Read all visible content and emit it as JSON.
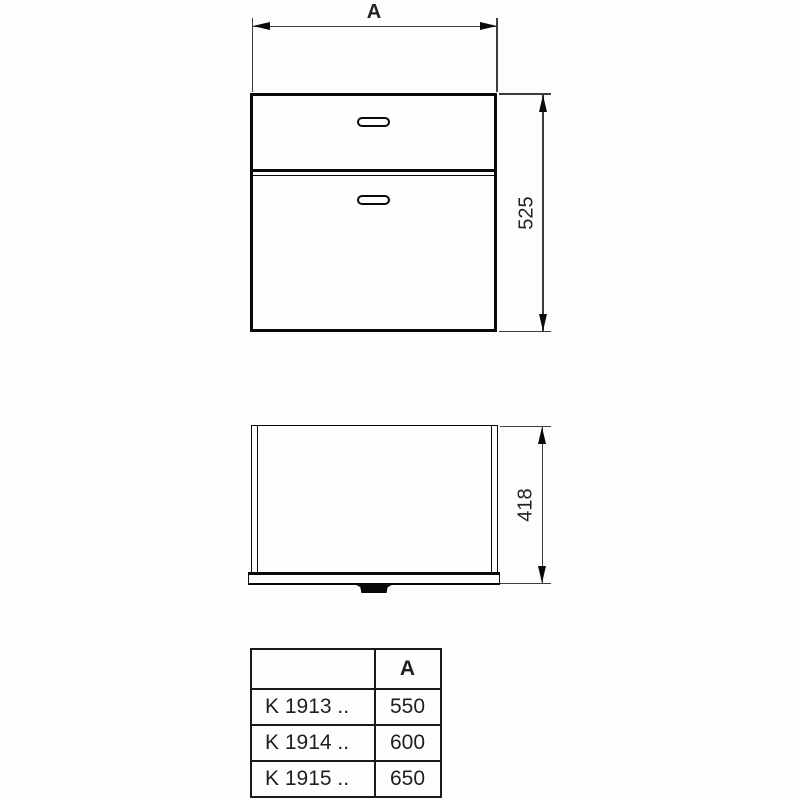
{
  "dims": {
    "width_label": "A",
    "height_value": "525",
    "depth_value": "418"
  },
  "table": {
    "headers": {
      "model": "",
      "a": "A"
    },
    "rows": [
      {
        "model": "K 1913 ..",
        "a": "550"
      },
      {
        "model": "K 1914 ..",
        "a": "600"
      },
      {
        "model": "K 1915 ..",
        "a": "650"
      }
    ]
  },
  "colors": {
    "object_line": "#0a0a0a",
    "dimension_line": "#3d3d3d",
    "background": "#fdfdfc"
  }
}
